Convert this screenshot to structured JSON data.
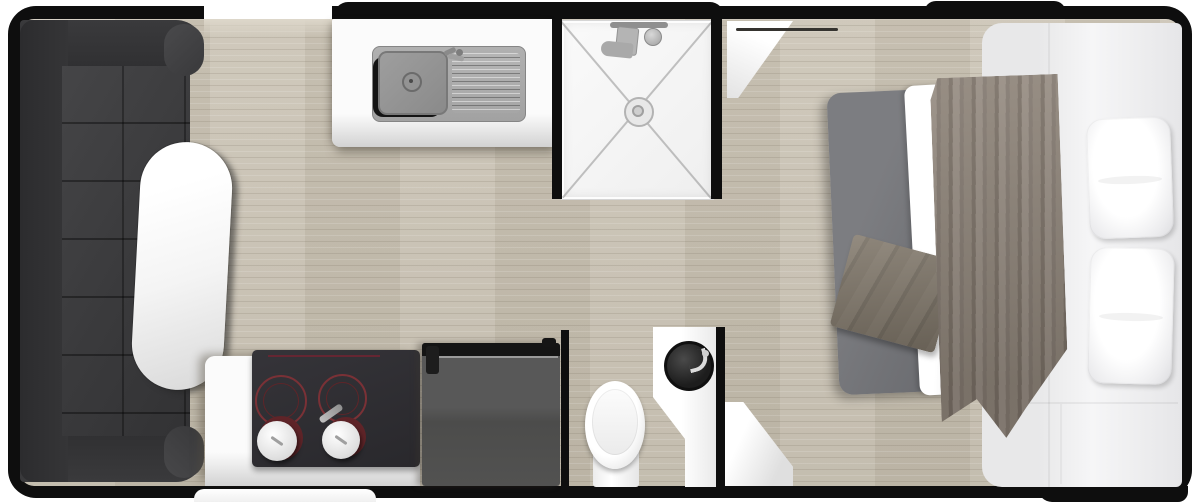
{
  "floorplan": {
    "scene": "caravan-studio-floor-plan",
    "colors": {
      "background": "#ffffff",
      "wall": "#0e0e0e",
      "floor": "#c8c1b2",
      "floor_light": "#ddd7ca",
      "sofa": "#3b3b3d",
      "sofa_dark": "#2d2d2f",
      "table": "#f4f4f4",
      "counter": "#f5f5f5",
      "steel": "#a9a9a9",
      "steel_dark": "#818181",
      "shower": "#f6f6f6",
      "shower_line": "#9f9f9f",
      "cooktop": "#2f2e32",
      "burner": "#7a3136",
      "knob": "#eeeeee",
      "cabinet": "#525251",
      "cabinet_rail": "#141414",
      "toilet": "#f4f4f4",
      "basin": "#1d1d1d",
      "chrome": "#dcdcdc",
      "door": "#f1f1f1",
      "bed_platform": "#ededee",
      "duvet": "#747579",
      "blanket": "#8b8177",
      "blanket_dark": "#736a60",
      "towel": "#7b7265",
      "pillow": "#f2f2f3"
    },
    "rooms": {
      "lounge": {
        "items": [
          "u-shaped-sofa",
          "oval-dining-table"
        ]
      },
      "kitchen": {
        "items": [
          "sink-counter",
          "sink-with-drainer",
          "sink-faucet",
          "hob-counter",
          "two-burner-cooktop",
          "control-knobs",
          "tall-cabinet"
        ]
      },
      "bathroom": {
        "items": [
          "shower-enclosure",
          "shower-head",
          "shower-drain",
          "toilet",
          "vanity-with-round-basin",
          "open-door"
        ]
      },
      "bedroom": {
        "items": [
          "bed-platform",
          "mattress-duvet",
          "folded-blanket",
          "folded-towel",
          "two-pillows"
        ]
      },
      "exterior": {
        "items": [
          "entry-opening",
          "entry-step",
          "roof-hatch",
          "rear-step"
        ]
      }
    }
  }
}
